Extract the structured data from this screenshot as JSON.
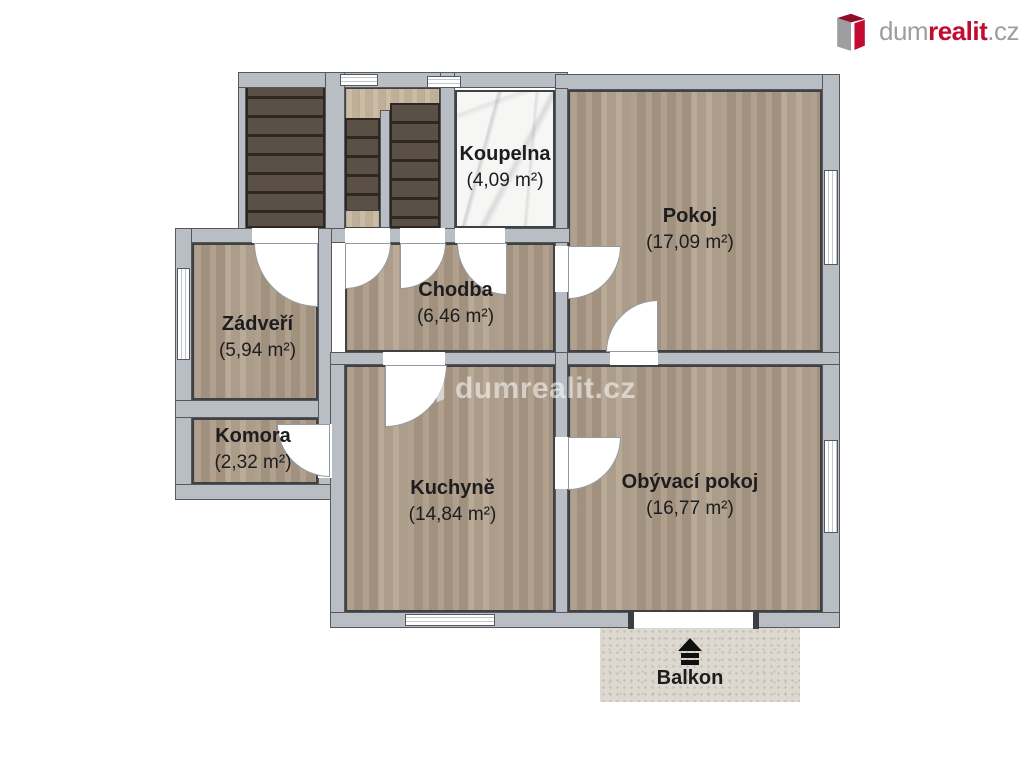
{
  "brand": {
    "dum": "dum",
    "realit": "realit",
    "cz": ".cz",
    "gray": "#9c9ea0",
    "red": "#c30b30"
  },
  "watermark": {
    "text": "dumrealit.cz"
  },
  "rooms": [
    {
      "name": "Koupelna",
      "area": "(4,09 m²)"
    },
    {
      "name": "Pokoj",
      "area": "(17,09 m²)"
    },
    {
      "name": "Zádveří",
      "area": "(5,94 m²)"
    },
    {
      "name": "Chodba",
      "area": "(6,46 m²)"
    },
    {
      "name": "Komora",
      "area": "(2,32 m²)"
    },
    {
      "name": "Kuchyně",
      "area": "(14,84 m²)"
    },
    {
      "name": "Obývací pokoj",
      "area": "(16,77 m²)"
    },
    {
      "name": "Balkon",
      "area": ""
    }
  ],
  "floors": {
    "wood": "#b2a18d",
    "stairs": "#52473d",
    "marble": "#f6f6f4",
    "balcony": "#ddd9d0",
    "wall": "#b9bec4"
  }
}
